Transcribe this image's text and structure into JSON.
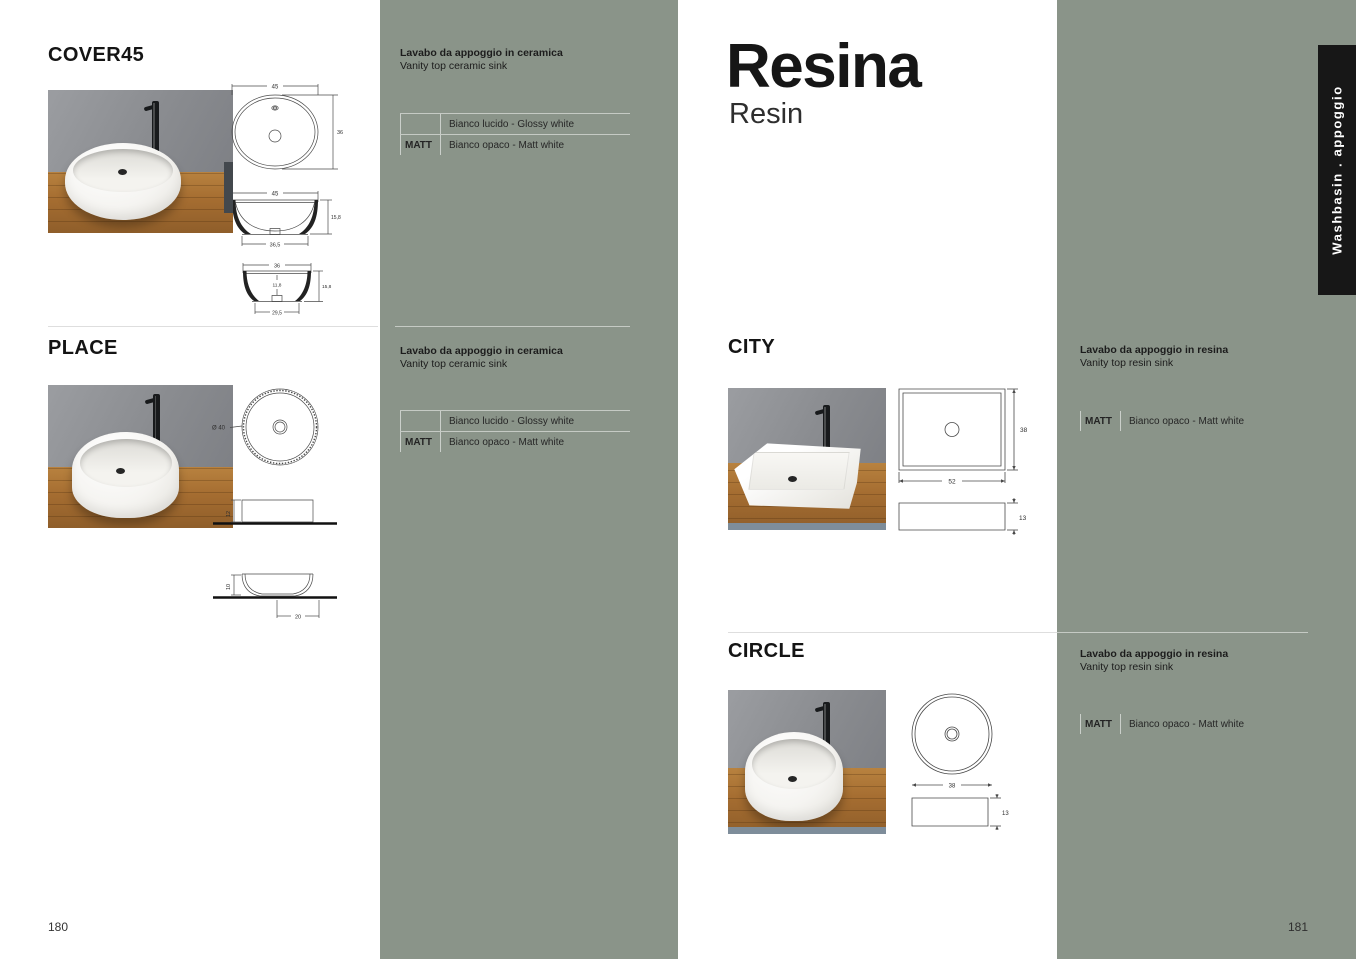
{
  "colors": {
    "sage_green": "#8a9489",
    "tab_black": "#171717",
    "accent_text": "#141414"
  },
  "left_page": {
    "page_number": "180",
    "products": [
      {
        "name": "COVER45",
        "desc_it": "Lavabo da appoggio in ceramica",
        "desc_en": "Vanity top ceramic sink",
        "finishes": [
          {
            "label": "",
            "value": "Bianco lucido - Glossy white"
          },
          {
            "label": "MATT",
            "value": "Bianco opaco - Matt white"
          }
        ],
        "dims": {
          "top_width": "45",
          "top_depth": "36",
          "front_width": "45",
          "front_height": "15,8",
          "front_base": "36,5",
          "side_width": "36",
          "side_inner_height": "11,8",
          "side_height": "15,8",
          "side_base": "29,5"
        }
      },
      {
        "name": "PLACE",
        "desc_it": "Lavabo da appoggio in ceramica",
        "desc_en": "Vanity top ceramic sink",
        "finishes": [
          {
            "label": "",
            "value": "Bianco lucido - Glossy white"
          },
          {
            "label": "MATT",
            "value": "Bianco opaco - Matt white"
          }
        ],
        "dims": {
          "diameter": "Ø 40",
          "block_height": "12",
          "bowl_height": "10",
          "base_width": "20"
        }
      }
    ]
  },
  "right_page": {
    "page_number": "181",
    "title": "Resina",
    "subtitle": "Resin",
    "tab": "Washbasin . appoggio",
    "products": [
      {
        "name": "CITY",
        "desc_it": "Lavabo da appoggio in resina",
        "desc_en": "Vanity top resin sink",
        "finishes": [
          {
            "label": "MATT",
            "value": "Bianco opaco - Matt white"
          }
        ],
        "dims": {
          "depth": "38",
          "width": "52",
          "height": "13"
        }
      },
      {
        "name": "CIRCLE",
        "desc_it": "Lavabo da appoggio in resina",
        "desc_en": "Vanity top resin sink",
        "finishes": [
          {
            "label": "MATT",
            "value": "Bianco opaco - Matt white"
          }
        ],
        "dims": {
          "diameter": "38",
          "height": "13"
        }
      }
    ]
  }
}
